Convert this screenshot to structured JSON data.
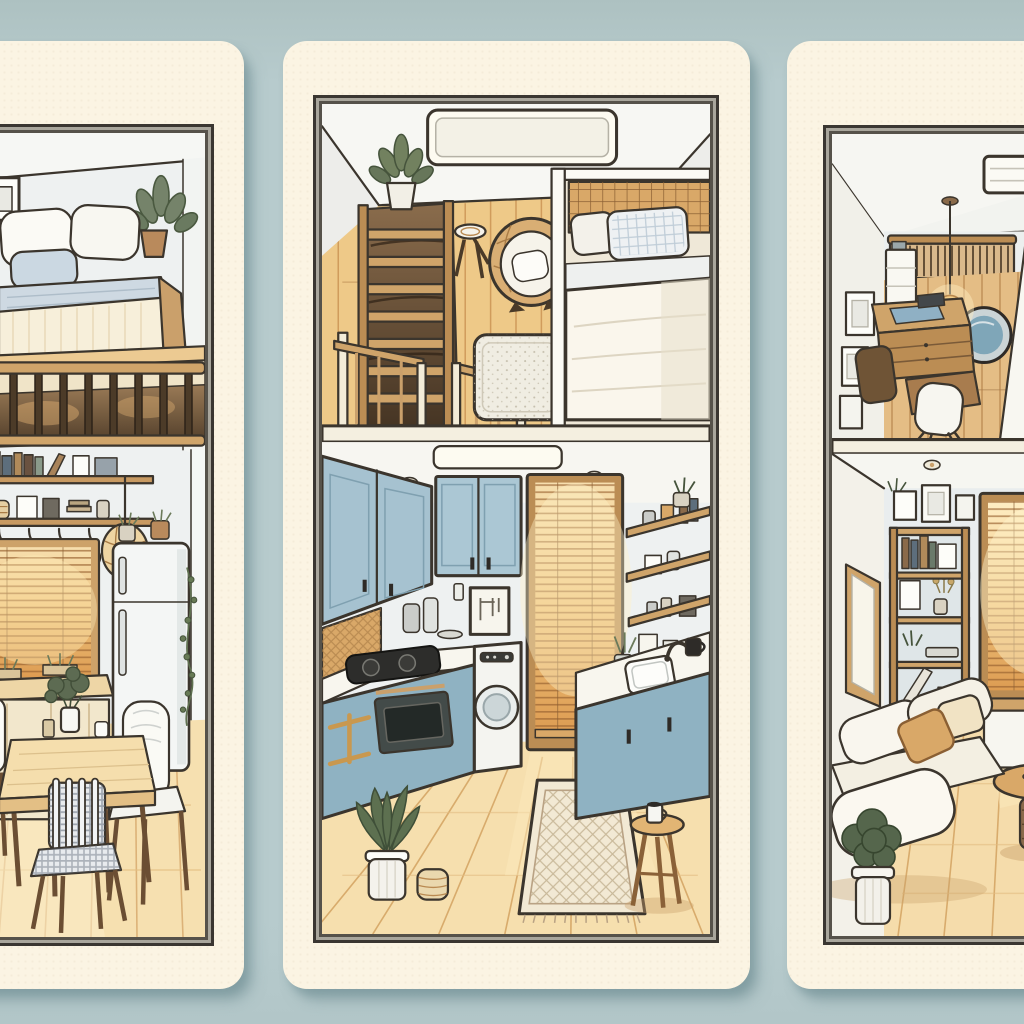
{
  "scene": {
    "kind": "digital-illustration",
    "title": "Three-panel illustration of tiny apartment interiors on a pale blue background",
    "background_color": "#b6cacc",
    "card_color": "#fbf4e3",
    "frame_color": "#3a3631",
    "panels": [
      {
        "id": "loft-bed-dining",
        "title": "Left panel: loft bed above a dining nook",
        "upper": "Loft bed with white pillows, blue-grey cushion, striped cream duvet, potted plant and small wall frame behind a wooden slat railing",
        "lower": "Dining nook with wooden table and plant centerpiece, plaid-cushion chair and white chairs, amber glowing venetian blinds, counter cabinet, book shelf, hook rail with hanging utensils, wicker pendant lamp and refrigerator with trailing vine"
      },
      {
        "id": "loft-kitchen",
        "title": "Middle panel: sleeping loft seen from above with galley kitchen below",
        "upper": "Skylight, wooden stair ladder with potted plant, stair railings, round rattan chair with white cushion, small stool, stippled rug and bed nook with lattice headboard, checked pillow and white duvet behind a partition wall",
        "lower": "Galley kitchen with blue upper and lower cabinets, gas cooktop, oven with brass rails, washing machine, glowing blinds over the doorway, framed sketch, open wooden shelves with jars and frames, sink with faucet and mug, diamond-pattern runner rug, spiky potted plant, coiled basket and wooden stool with mug"
      },
      {
        "id": "study-living",
        "title": "Right panel: mezzanine study above a cozy living room",
        "upper": "Overhead study with wooden desk and drawers, blue desk mat, two chairs, white shelf tower, slatted radiator panel, glowing pendant bulb, round blue rug, picture frames and ceiling vent",
        "lower": "Living room with white sofa, tan and cream pillows, leafy potted plant, round wooden coffee table with woven base, tall wooden bookshelf with books, frames and plants, framed wall art, sunlit amber blinds and white sideboard"
      }
    ],
    "palette": {
      "outline": "#3b352d",
      "wood": "#c89a5f",
      "wood_light": "#ecd2a2",
      "floor": "#f5dfae",
      "cabinet_blue": "#9cbcca",
      "linen_white": "#f8f5ec",
      "pillow_blue": "#c9d6e0",
      "amber_glow": "#f3c67c",
      "leaf_green": "#5d7050",
      "card_shadow": "#9fb6ba"
    }
  }
}
